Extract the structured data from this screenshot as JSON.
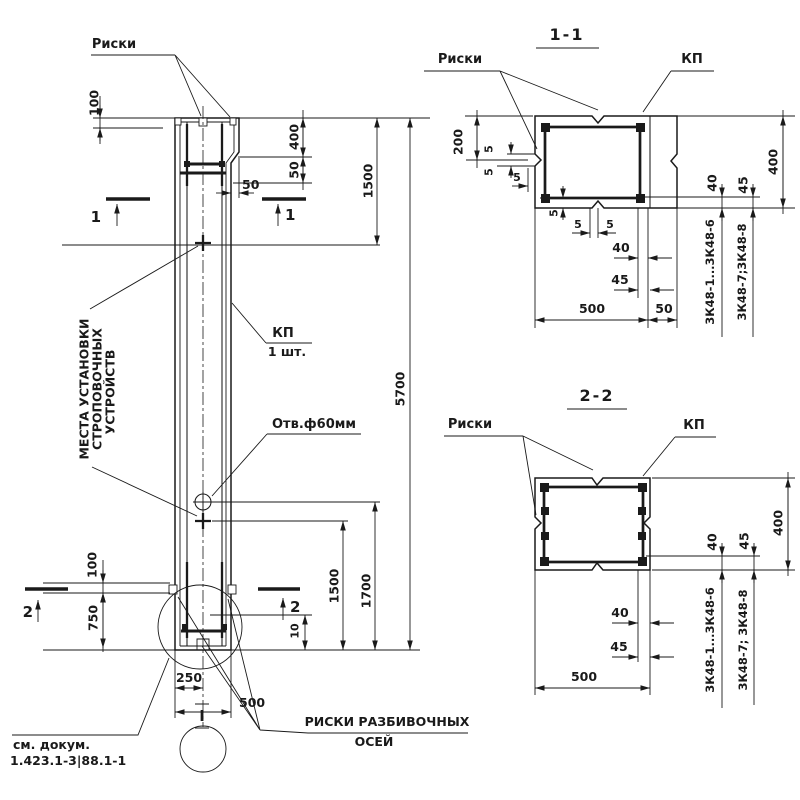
{
  "colors": {
    "background": "#ffffff",
    "ink": "#1a1a1a"
  },
  "elevation": {
    "riski_label": "Риски",
    "strop_note_1": "МЕСТА УСТАНОВКИ",
    "strop_note_2": "СТРОПОВОЧНЫХ",
    "strop_note_3": "УСТРОЙСТВ",
    "kp_label": "КП",
    "kp_qty": "1 шт.",
    "hole_label": "Отв.ф60мм",
    "axes_note_1": "РИСКИ РАЗБИВОЧНЫХ",
    "axes_note_2": "ОСЕЙ",
    "doc_note_1": "см. докум.",
    "doc_note_2": "1.423.1-3|88.1-1",
    "detail_mark": "I",
    "cut_1": "1",
    "cut_2": "2",
    "dims": {
      "top_100": "100",
      "console_400": "400",
      "console_50v": "50",
      "console_50h": "50",
      "upper_1500": "1500",
      "total_5700": "5700",
      "lower_1500": "1500",
      "lower_1700": "1700",
      "bottom_10": "10",
      "axis_100": "100",
      "axis_750": "750",
      "half_250": "250",
      "width_500": "500"
    }
  },
  "section_1_1": {
    "title": "1-1",
    "riski_label": "Риски",
    "kp_label": "КП",
    "bar_mark_1": "3К48-1...3К48-6",
    "bar_mark_2": "3К48-7;3К48-8",
    "dims": {
      "half_200": "200",
      "cover_5": "5",
      "bar_40": "40",
      "bar_45": "45",
      "height_400": "400",
      "bot_40": "40",
      "bot_45": "45",
      "width_500": "500",
      "step_50": "50"
    }
  },
  "section_2_2": {
    "title": "2-2",
    "riski_label": "Риски",
    "kp_label": "КП",
    "bar_mark_1": "3К48-1...3К48-6",
    "bar_mark_2": "3К48-7; 3К48-8",
    "dims": {
      "bar_40": "40",
      "bar_45": "45",
      "height_400": "400",
      "bot_40": "40",
      "bot_45": "45",
      "width_500": "500"
    }
  }
}
